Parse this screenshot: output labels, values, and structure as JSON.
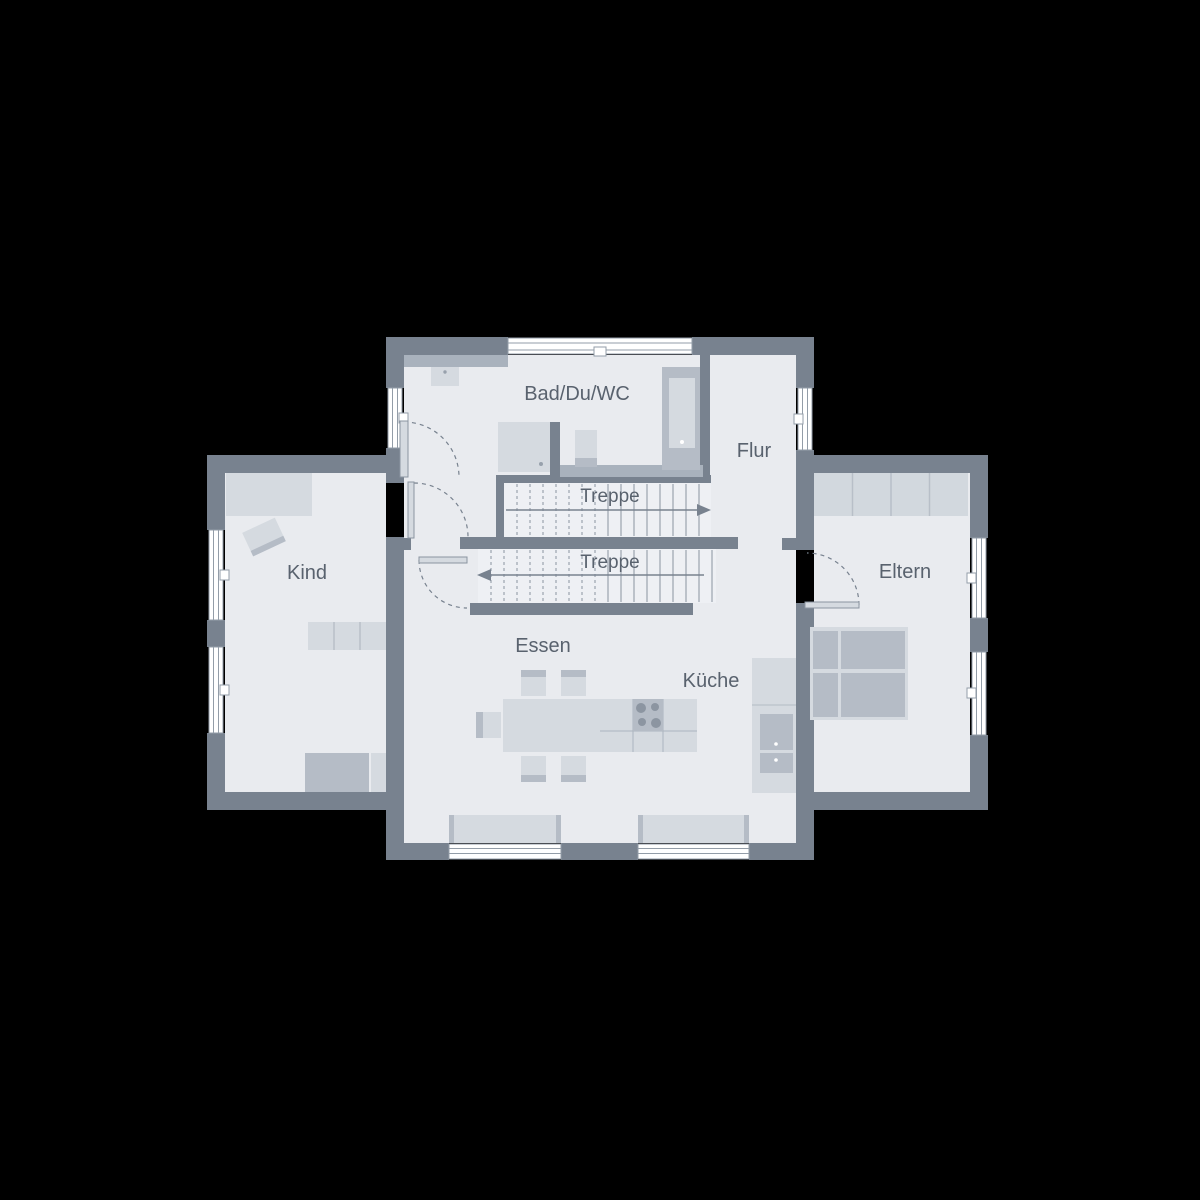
{
  "plan": {
    "labels": {
      "bathroom": "Bad/Du/WC",
      "hallway": "Flur",
      "stair_upper": "Treppe",
      "stair_lower": "Treppe",
      "child_room": "Kind",
      "parents_room": "Eltern",
      "dining": "Essen",
      "kitchen": "Küche"
    },
    "colors": {
      "background": "#000000",
      "wall": "#78828F",
      "floor": "#E9EBEF",
      "stair_floor": "#EEF0F4",
      "furniture_light": "#D5DAE0",
      "furniture_medium": "#B5BCC6",
      "fixture_band": "#A9B2BD",
      "window_glass": "#FFFFFF",
      "label_text": "#59626E"
    }
  }
}
